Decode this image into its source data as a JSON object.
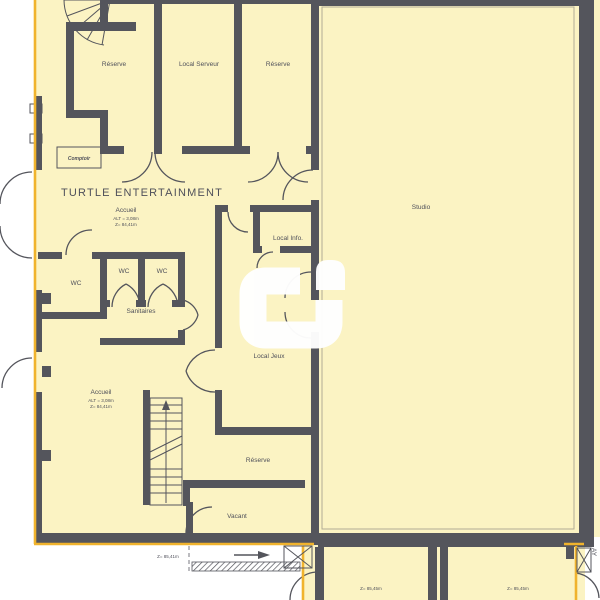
{
  "plan": {
    "title": "TURTLE ENTERTAINMENT",
    "colors": {
      "paper": "#ffffff",
      "floor": "#FBF3C3",
      "wall": "#54555C",
      "boundary": "#F0B32D",
      "ink": "#4F505A"
    },
    "rooms": {
      "reserve_top_left": "Réserve",
      "local_serveur": "Local Serveur",
      "reserve_top_right": "Réserve",
      "studio": "Studio",
      "comptoir": "Comptoir",
      "accueil_upper": {
        "name": "Accueil",
        "alt": "ALT = 3,08m",
        "level": "Z= 84,41m"
      },
      "local_info": "Local Info.",
      "wc_left": "WC",
      "wc_middle": "WC",
      "wc_right": "WC",
      "sanitaires": "Sanitaires",
      "local_jeux": "Local Jeux",
      "accueil_lower": {
        "name": "Accueil",
        "alt": "ALT = 3,08m",
        "level": "Z= 84,41m"
      },
      "reserve_middle": "Réserve",
      "vacant": "Vacant"
    },
    "annotations": {
      "corridor_level": "Z= 85,41m",
      "lower_room_left_level": "Z= 85,45m",
      "lower_room_right_level": "Z= 85,45m",
      "edge_text": "AY"
    }
  }
}
